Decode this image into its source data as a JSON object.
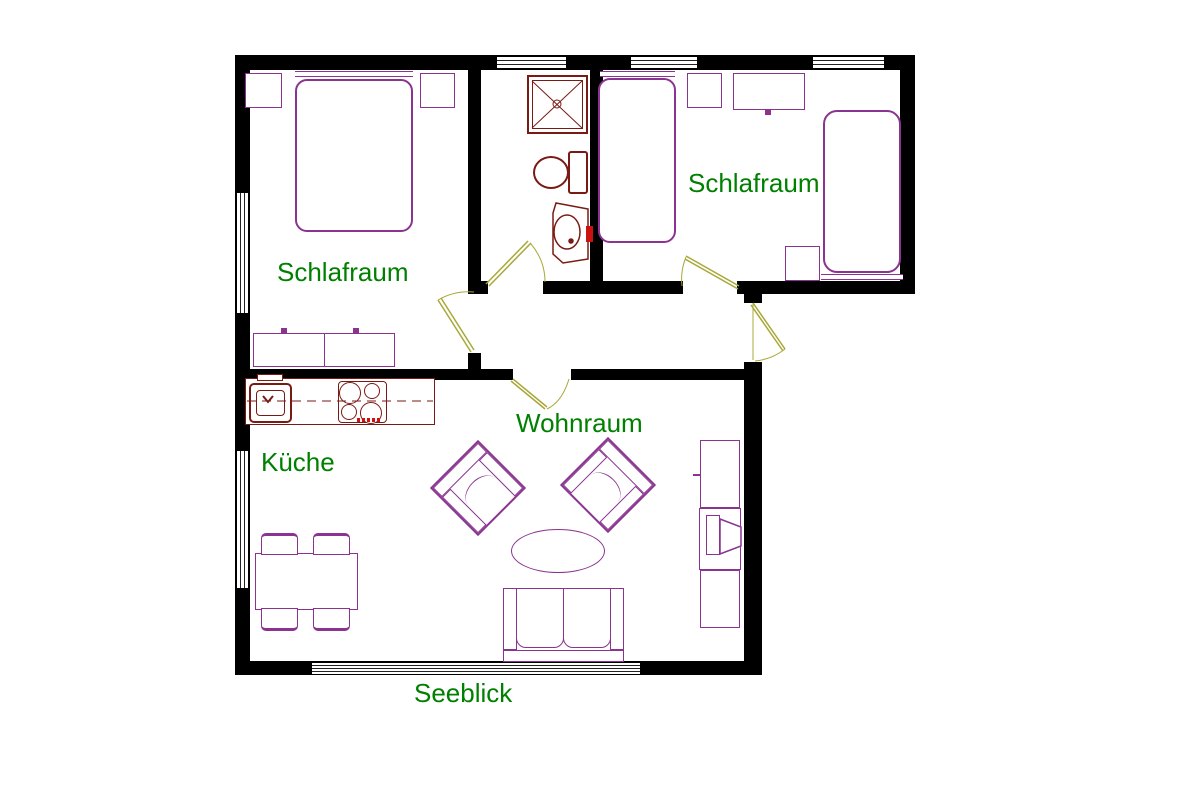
{
  "labels": {
    "bedroom_left": "Schlafraum",
    "bedroom_right": "Schlafraum",
    "living_room": "Wohnraum",
    "kitchen": "Küche",
    "view": "Seeblick"
  },
  "colors": {
    "wall": "#000000",
    "furniture": "#8A3390",
    "fixture": "#7A1A14",
    "accent": "#CC1111",
    "door": "#A8A838",
    "label": "#008000",
    "window_line": "#222222"
  }
}
